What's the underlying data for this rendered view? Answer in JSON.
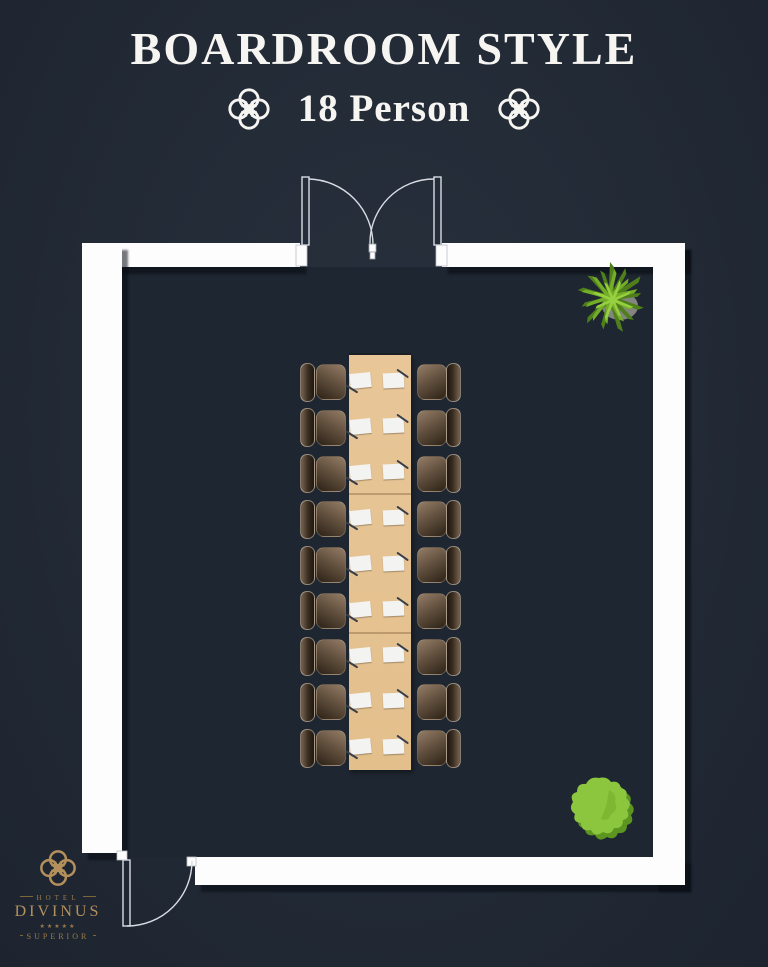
{
  "header": {
    "title": "BOARDROOM STYLE",
    "capacity_label": "18 Person",
    "text_color": "#f6f5f2"
  },
  "floorplan": {
    "layout_name": "boardroom",
    "seats_total": 18,
    "seats_per_side": 9,
    "table_sections": 3,
    "doors": [
      "double-door-top",
      "single-door-bottom-left"
    ],
    "wall_color": "#fdfdfd",
    "floor_color": "#1e2631",
    "table_color": "#e5c291",
    "chair_dark": "#302519",
    "chair_light": "#8f7963",
    "paper_color": "#f3f3f1",
    "plant_green": "#8cc63f",
    "plant_green_dark": "#5c8f1e"
  },
  "branding": {
    "hotel_label": "HOTEL",
    "name": "DIVINUS",
    "stars": "★★★★★",
    "tier": "SUPERIOR",
    "gold": "#b4905a"
  }
}
